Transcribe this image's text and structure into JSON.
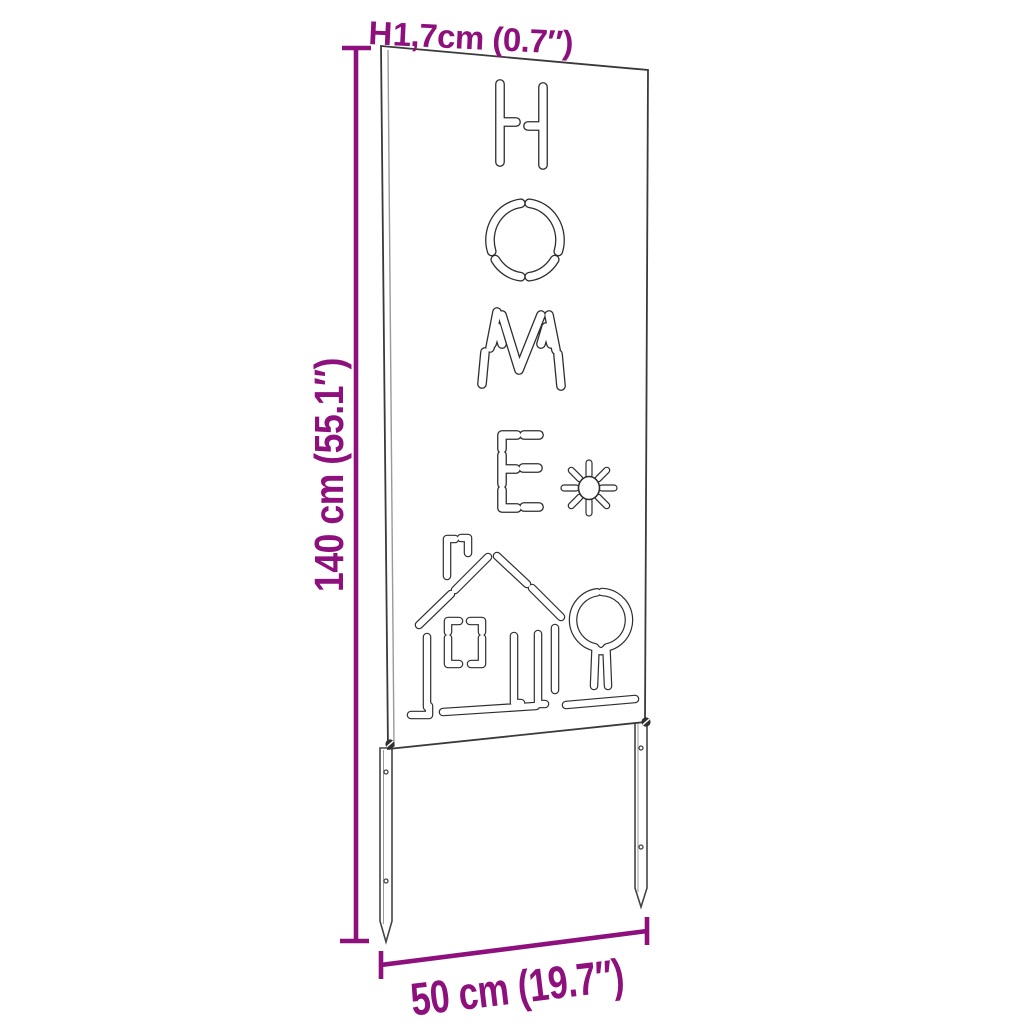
{
  "dimensions": {
    "height_label": "140 cm (55.1″)",
    "thickness_bracket": "H",
    "thickness_label": "1,7cm (0.7″)",
    "width_label": "50 cm (19.7″)"
  },
  "panel": {
    "cutout_word": "HOME",
    "cutout_motifs": [
      "sun-icon",
      "house-icon",
      "tree-icon"
    ],
    "stake_count": 2
  },
  "colors": {
    "accent_purple": "#8d107c",
    "outline": "#2e2e2e",
    "background": "#ffffff"
  }
}
